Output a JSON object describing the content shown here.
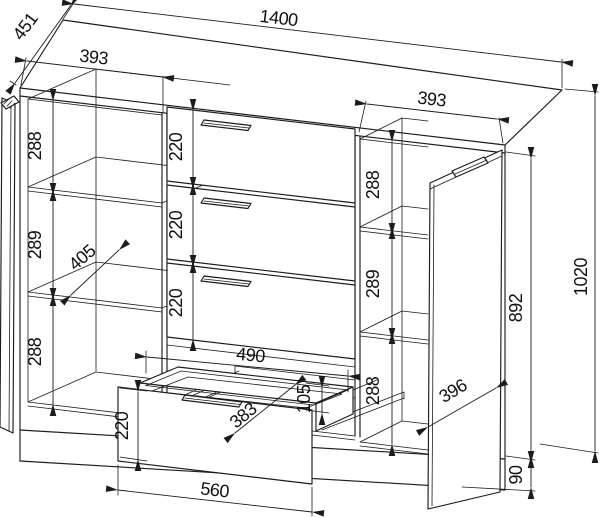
{
  "drawing": {
    "type": "furniture-technical-drawing",
    "subject": "sideboard-with-drawers-and-doors",
    "colors": {
      "line": "#1c1c1c",
      "background": "#ffffff"
    },
    "dims": {
      "overall_width": "1400",
      "overall_depth": "451",
      "overall_height": "1020",
      "carcass_side_height": "892",
      "plinth_height": "90",
      "left_section_width": "393",
      "right_section_width": "393",
      "left_compartment_top": "288",
      "left_compartment_middle": "289",
      "left_compartment_bottom": "288",
      "interior_shelf_depth": "405",
      "drawer_front_1": "220",
      "drawer_front_2": "220",
      "drawer_front_3": "220",
      "right_compartment_top": "288",
      "right_compartment_middle": "289",
      "right_compartment_bottom": "288",
      "door_width": "396",
      "drawer_box_inner_width": "490",
      "drawer_box_side_height": "105",
      "drawer_box_depth": "383",
      "pulled_drawer_front_height": "220",
      "pulled_drawer_front_width": "560"
    }
  }
}
